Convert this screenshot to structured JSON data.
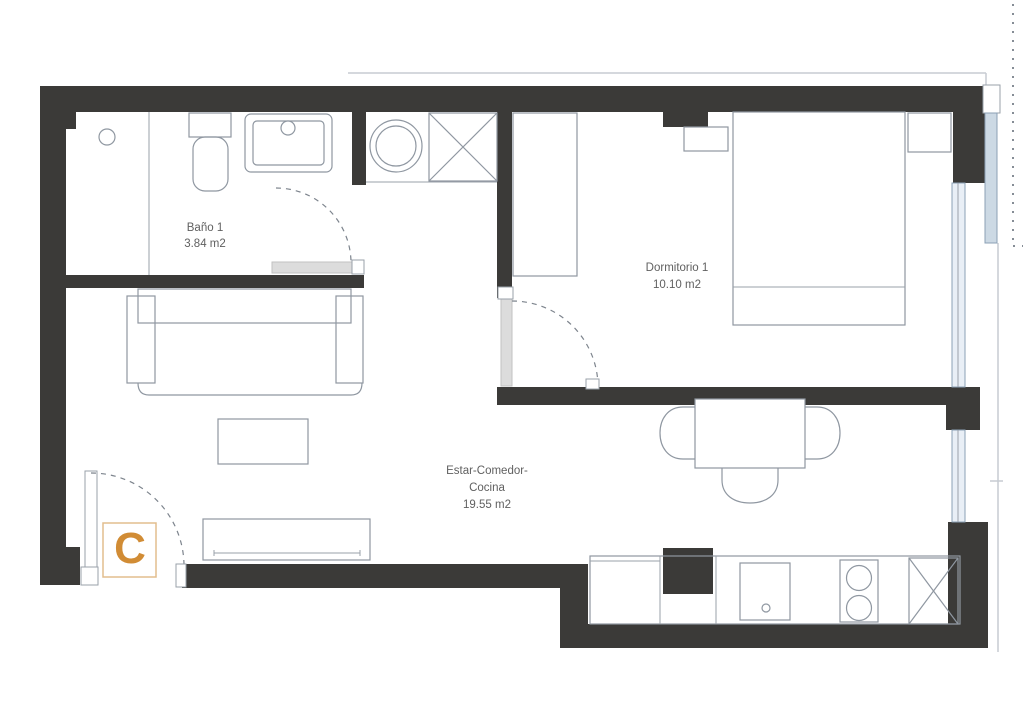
{
  "plan_type": "apartment-floor-plan",
  "rooms": {
    "bathroom": {
      "name": "Baño 1",
      "area": "3.84 m2"
    },
    "bedroom": {
      "name": "Dormitorio 1",
      "area": "10.10 m2"
    },
    "living": {
      "name_line1": "Estar-Comedor-",
      "name_line2": "Cocina",
      "area": "19.55 m2"
    }
  },
  "entrance": {
    "label": "C"
  },
  "colors": {
    "wall": "#3b3a38",
    "furniture_line": "#8f97a1",
    "label_text": "#606060",
    "entrance_accent": "#d18c35",
    "entrance_box_border": "#e2bd8d",
    "window_fill": "#e9eff6",
    "outer_window_fill": "#ccd9e4",
    "door_leaf_fill": "#dcdcdc",
    "background": "#ffffff"
  }
}
